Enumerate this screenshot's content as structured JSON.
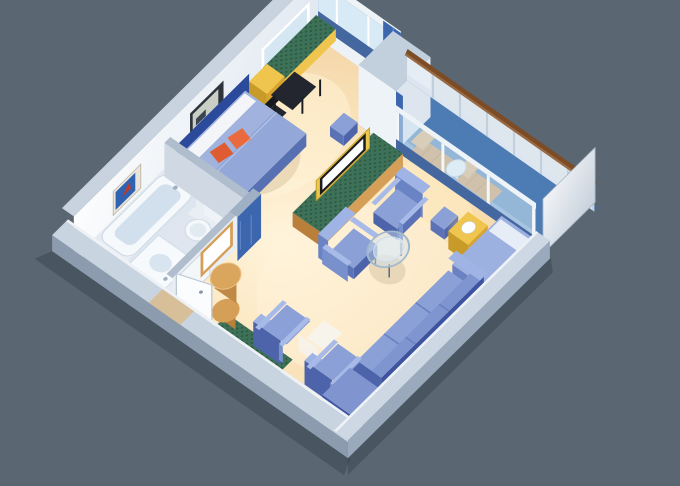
{
  "scene": {
    "type": "isometric-cutaway-floor-plan",
    "subject": "one-bedroom suite with private balcony",
    "rooms": [
      "bathroom",
      "entry-hall",
      "bedroom",
      "living-room",
      "balcony"
    ]
  },
  "palette": {
    "bg": "#5a6773",
    "modelShadow": "#19232f",
    "floorLight": "#fff4dc",
    "floorMid": "#fbe6c0",
    "floorEdge": "#f2d2a2",
    "glowWarm": "#fff3d8",
    "glowDoor": "#ffedc4",
    "bathFloor": "#e9eef5",
    "balconyFloor": "#4d7cb5",
    "balconyFloorLight": "#7fa3cc",
    "balconyEdge": "#3f689e",
    "railPanel": "#e6edf4",
    "railStanchion": "#c2cfdc",
    "railWood": "#7c4c27",
    "railWoodHi": "#9a6a42",
    "loungerSeat": "#cf9654",
    "loungerBack": "#e2b074",
    "loungerSlat": "#b5803f",
    "deckTableTop": "#f0f4f8",
    "deckTableStem": "#d8dee6",
    "deckTableRim": "#c8d2dc",
    "dividerLight": "#ffffff",
    "dividerDark": "#b9c5d3",
    "dividerEdge": "#9fb0c2",
    "wallWhite": "#ffffff",
    "wallShade": "#e2e9f1",
    "wallShadeBand": "#dde4ee",
    "wallCap": "#c8d3df",
    "wallCapDark": "#b0bdcd",
    "innerWallFace": "#cfd8e3",
    "hallWallFace": "#e9eef5",
    "bpCap": "#9fb0c4",
    "sill": "#edf2f7",
    "blueBand": "#44679f",
    "glassSky": "#d8eaf6",
    "glassTint": "#d0e5f3",
    "glassTop": "#eef3f8",
    "glassPost": "#f4f7fa",
    "curtain": "#3c66ad",
    "curtainLight": "#5b82c4",
    "artBathFrame": "#e8e4da",
    "artBathFrameEdge": "#b9b29f",
    "artBlue": "#2f62b0",
    "artRed": "#c03a2a",
    "artBedFrame": "#2f343c",
    "artBedInner": "#c9cfc4",
    "artBedBlob": "#3c4450",
    "mirrorGlass": "#d4e7f3",
    "hallMirror": "#fefefe",
    "woodYellow": "#f0c54e",
    "woodYellowDark": "#d9a42e",
    "woodYellowSide": "#c89a28",
    "greenBase": "#3e7258",
    "greenDot": "#2c5743",
    "woodTan": "#d59f58",
    "woodTanDark": "#b97f3b",
    "drumBody": "#c08a46",
    "drumTop": "#daa55c",
    "drumRim": "#ecc083",
    "deskBlack": "#23262e",
    "deskBlack2": "#15181e",
    "deskLeg": "#1a1d24",
    "headboard": "#2c4a9c",
    "bedTop": "#93a8d9",
    "bedSide": "#5670b2",
    "bedFoot": "#5d74b4",
    "sheenWhite": "#ffffff",
    "pillowWhite": "#f3f5f9",
    "pillowOrange": "#df5c33",
    "pillowOrange2": "#e96a3e",
    "bedShadow": "#8a6a3a",
    "seatTop": "#8ba0d6",
    "seatFront": "#4d63aa",
    "seatSide": "#5b72b6",
    "backFace": "#6a83c4",
    "backTop": "#9fb4e4",
    "armTop": "#a8bbe8",
    "armFace": "#7890cc",
    "sofaDark": "#3d53a0",
    "sofaBackTop": "#7e95d0",
    "sofaCornerTop": "#8095cf",
    "sofaLine": "#6a81c2",
    "sofabedTop": "#9db1e0",
    "sofabedFace": "#6a81c2",
    "sofabedPillow": "#eef2f8",
    "tvFrame": "#e8c94e",
    "tvFrameEdge": "#c8a32e",
    "tvScreen": "#fdfefe",
    "tvScreenEdge": "#1c1c1c",
    "tubFace": "#dde5ee",
    "tubTop": "#f6f9fc",
    "tubBasin": "#d2dfec",
    "fixtureEdge": "#cdd8e4",
    "sinkFace": "#e4ebf2",
    "sinkTop": "#f7fafc",
    "sinkBasin": "#d8e4ef",
    "tapMetal": "#9fb0c2",
    "tankFace": "#eef3f8",
    "tankTop": "#e0e8f0",
    "bowlFill": "#f4f8fb",
    "bowlSeat": "#e2eaf2",
    "bathShade": "#c9d4e0",
    "doorLeaf": "#fbfcfe",
    "doorEdge": "#b9c6d4",
    "knob": "#8a97a8",
    "doorwayEdge": "#c8d2dd",
    "wallOuterBottom": "#8c9cae",
    "capBottom": "#c9d4e1",
    "lipWhite": "#eef2f7",
    "threshold": "#d9bb8d",
    "wallOuterRight": "#9aaabc",
    "capRight": "#cdd8e4",
    "glowLamp": "#ffe289",
    "lampBall": "#fbfdff",
    "lampBallEdge": "#cfc7a8",
    "glassTableFill": "#cfe0f0",
    "glassTableRim": "#9fb8cc",
    "glassTableInner": "#e4f0f8",
    "glassTableInnerRim": "#c9dcec",
    "glassTableLeg": "#5a6a80",
    "whiteChairFill": "#f4f7fb",
    "tableShadow": "#6a5533"
  }
}
